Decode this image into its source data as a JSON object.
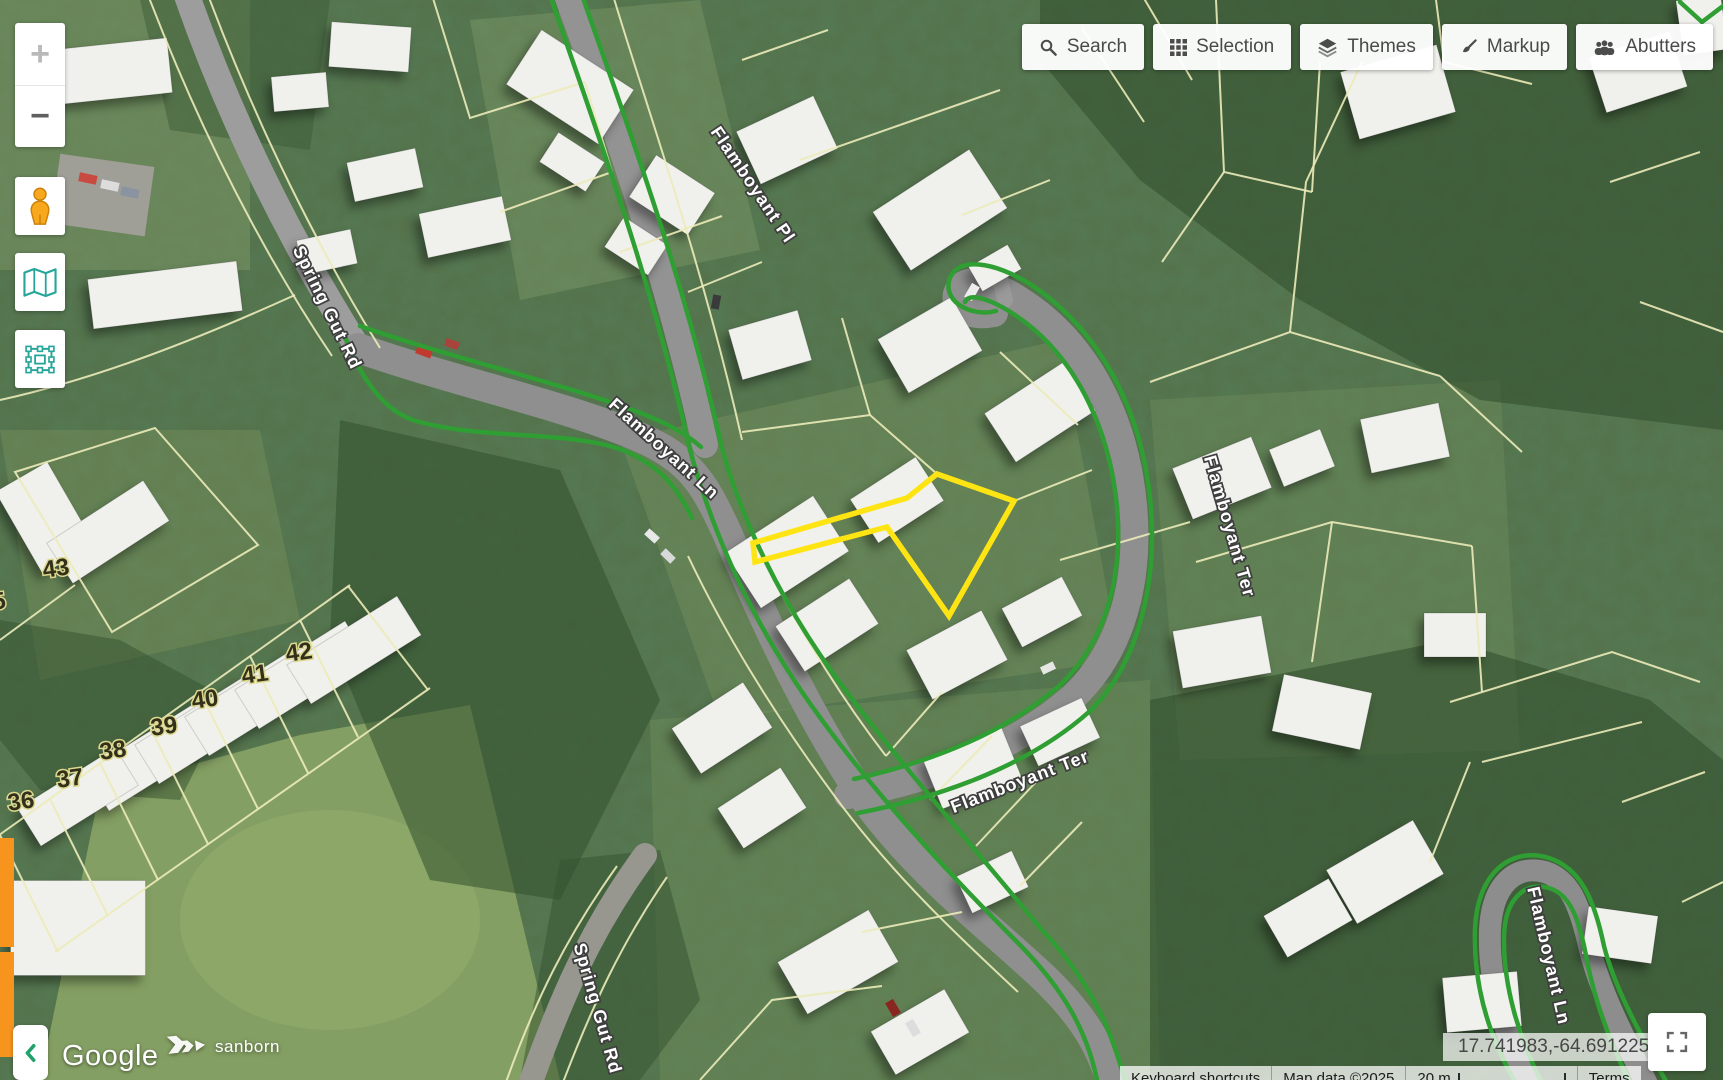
{
  "toolbar": {
    "buttons": [
      {
        "label": "Search",
        "icon": "search-icon"
      },
      {
        "label": "Selection",
        "icon": "selection-grid-icon"
      },
      {
        "label": "Themes",
        "icon": "themes-layers-icon"
      },
      {
        "label": "Markup",
        "icon": "markup-brush-icon"
      },
      {
        "label": "Abutters",
        "icon": "abutters-people-icon"
      }
    ]
  },
  "map_controls": {
    "zoom_in": "+",
    "zoom_out": "−"
  },
  "street_labels": [
    {
      "text": "Spring Gut Rd"
    },
    {
      "text": "Flamboyant Pl"
    },
    {
      "text": "Flamboyant Ln"
    },
    {
      "text": "Flamboyant Ter"
    },
    {
      "text": "Flamboyant Ter"
    },
    {
      "text": "Spring Gut Rd"
    },
    {
      "text": "Flamboyant Ln"
    }
  ],
  "parcel_labels": [
    {
      "text": "43"
    },
    {
      "text": "42"
    },
    {
      "text": "41"
    },
    {
      "text": "40"
    },
    {
      "text": "39"
    },
    {
      "text": "38"
    },
    {
      "text": "37"
    },
    {
      "text": "36"
    },
    {
      "text": "5"
    }
  ],
  "attribution": {
    "google": "Google",
    "provider": "sanborn",
    "keyboard_shortcuts": "Keyboard shortcuts",
    "map_data": "Map data ©2025",
    "scale_label": "20 m",
    "terms": "Terms"
  },
  "statusbar": {
    "coordinates": "17.741983,-64.691225"
  },
  "colors": {
    "selection_outline": "#ffe414",
    "road_edge_green": "#2f9e33",
    "parcel_line": "#ecebb9",
    "accent_teal": "#26a69a",
    "accent_orange": "#f7941e",
    "button_text": "#4a4a4a"
  }
}
